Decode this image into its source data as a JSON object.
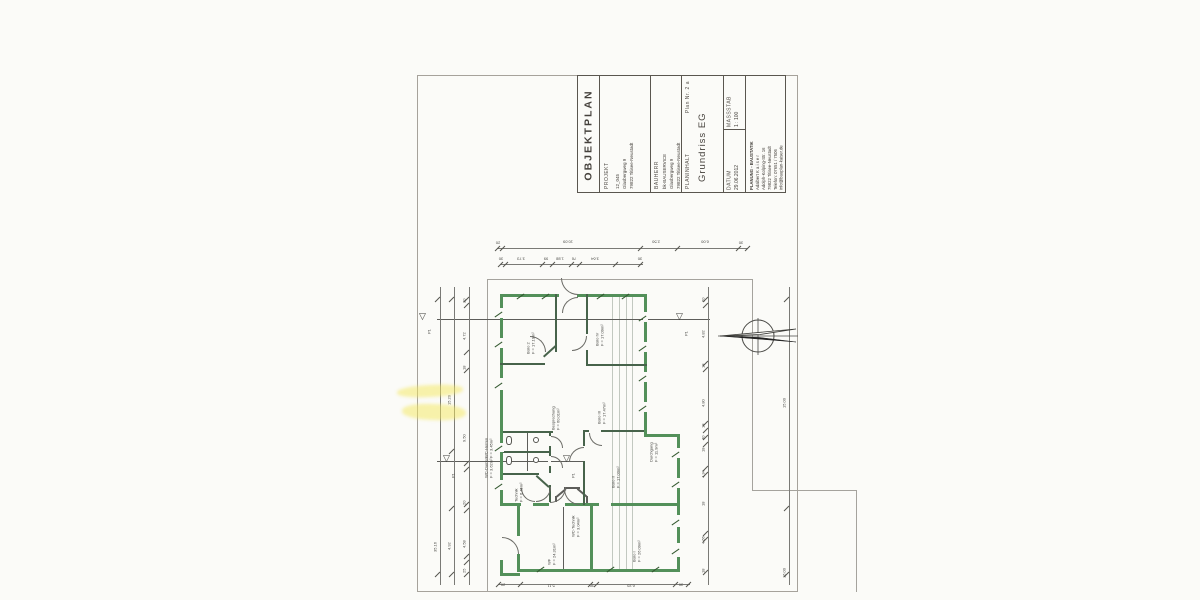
{
  "title_block": {
    "title": "OBJEKTPLAN",
    "projekt": {
      "label": "PROJEKT",
      "line1": "12_045",
      "line2": "Glasbergweg 9",
      "line3": "79822 Titisee-Neustadt"
    },
    "bauherr": {
      "label": "BAUHERR",
      "line1": "bk-BAUSERVICE",
      "line2": "Glasbergweg 9",
      "line3": "79822 Titisee-Neustadt"
    },
    "planinhalt": {
      "label": "PLANINHALT",
      "plan_nr": "Plan Nr. 2 a",
      "content": "Grundriss EG"
    },
    "massstab": {
      "label": "MASSSTAB",
      "value": "1 : 100"
    },
    "datum": {
      "label": "DATUM",
      "value": "29.06.2012"
    },
    "planung": {
      "label": "PLANUNG - BAUSTATIK",
      "line1": "Adalbert K a i s e r",
      "line2": "Adolph-Kolping-Str. 16",
      "line3": "79822 Titisee-Neustadt",
      "line4": "Telefon: 07651 / 7506",
      "line5": "info@bauplan-kaiser.de"
    }
  },
  "rooms": {
    "buero2": {
      "name": "Büro 2",
      "area": "F = 17.19m²"
    },
    "buero4": {
      "name": "Büro IV",
      "area": "F = 17.09m²"
    },
    "buero3": {
      "name": "Büro III",
      "area": "F = 17.47m²"
    },
    "besprechung": {
      "name": "Besprechung",
      "area": "F = 60.01m²"
    },
    "buero2b": {
      "name": "Büro II",
      "area": "F = 17.00m²"
    },
    "durchgang": {
      "name": "Durchgang",
      "area": "F = 11.9m²"
    },
    "wc_herren": {
      "name": "WC-Herren",
      "area": "F = 3.45m²"
    },
    "wc_damen": {
      "name": "WC-Damen",
      "area": "F = 3.62m²"
    },
    "technik": {
      "name": "Technik",
      "area": "F = 6.45m²"
    },
    "wc_technik": {
      "name": "WC-Technik",
      "area": "F = 3.04m²"
    },
    "wf": {
      "name": "WF",
      "area": "F = 24.31m²"
    },
    "buero1": {
      "name": "Büro I",
      "area": "F = 26.09m²"
    }
  },
  "dims": {
    "top1": [
      "20",
      "10.09",
      "2.50",
      "6.00",
      "30"
    ],
    "top2": [
      "30",
      "3.73",
      "99",
      "1.88",
      "76",
      "3.64",
      "30"
    ],
    "left_outer": [
      "35.16"
    ],
    "left_mid": [
      "15.20",
      "4.92"
    ],
    "left_inner": [
      "20",
      "4.72",
      "18",
      "9.50",
      "20",
      "4.58",
      "25"
    ],
    "right_inner": [
      "20",
      "4.82",
      "18",
      "4.80",
      "18",
      "40",
      "18",
      "4.34",
      "18",
      "4.66",
      "18"
    ],
    "right_outer": [
      "15.00",
      "16.00"
    ],
    "bottom": [
      "20",
      "5.11",
      "36",
      "6.20",
      "30"
    ]
  },
  "markers": {
    "p": "P1"
  },
  "colors": {
    "wall_green": "#53905a",
    "paper": "#fbfbf8",
    "highlight": "#f4e85c"
  }
}
